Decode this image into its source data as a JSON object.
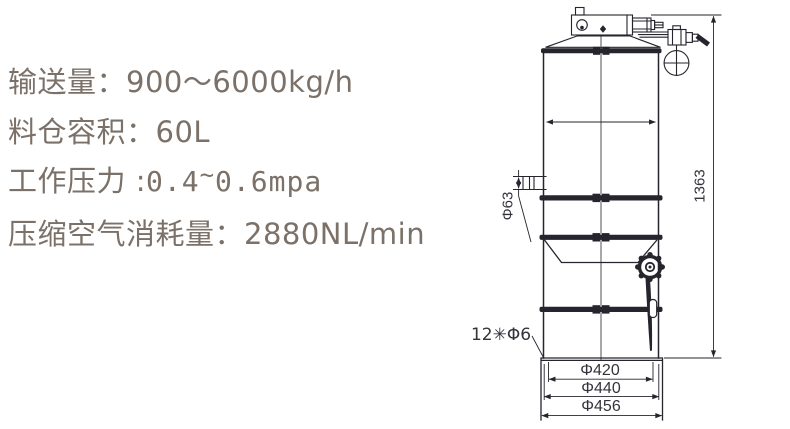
{
  "specs": {
    "conveying": "输送量：900～6000kg/h",
    "hopper": "料仓容积：60L",
    "pressure_label": "工作压力 :",
    "pressure_v1": "0.4",
    "pressure_tilde": "~",
    "pressure_v2": "0.6mpa",
    "air": "压缩空气消耗量：2880NL/min"
  },
  "drawing": {
    "labels": {
      "inlet_diameter": "Φ63",
      "overall_height": "1363",
      "bolt_pattern": "12✳Φ6",
      "flange_d1": "Φ420",
      "flange_d2": "Φ440",
      "flange_d3": "Φ456"
    }
  },
  "colors": {
    "spec_text": "#7b7168",
    "drawing_line": "#26242c",
    "dim_text": "#34333b"
  }
}
